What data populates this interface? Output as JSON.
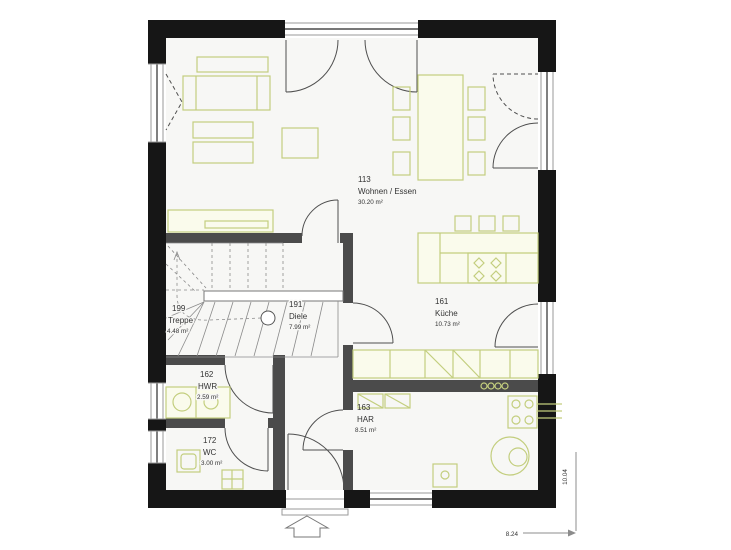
{
  "plan": {
    "rooms": [
      {
        "number": "113",
        "name": "Wohnen / Essen",
        "area": "30.20 m²"
      },
      {
        "number": "161",
        "name": "Küche",
        "area": "10.73 m²"
      },
      {
        "number": "199",
        "name": "Treppe",
        "area": "4.48 m²"
      },
      {
        "number": "191",
        "name": "Diele",
        "area": "7.99 m²"
      },
      {
        "number": "162",
        "name": "HWR",
        "area": "2.59 m²"
      },
      {
        "number": "172",
        "name": "WC",
        "area": "3.00 m²"
      },
      {
        "number": "163",
        "name": "HAR",
        "area": "8.51 m²"
      }
    ],
    "dimensions": {
      "width": "8.24",
      "height": "10.04"
    },
    "colors": {
      "exterior_wall": "#161616",
      "interior_wall": "#4b4b4b",
      "furniture_stroke": "#c3ce7e",
      "furniture_fill": "#fafbec",
      "floor": "#f7f7f5",
      "line": "#4f4f4f"
    }
  }
}
